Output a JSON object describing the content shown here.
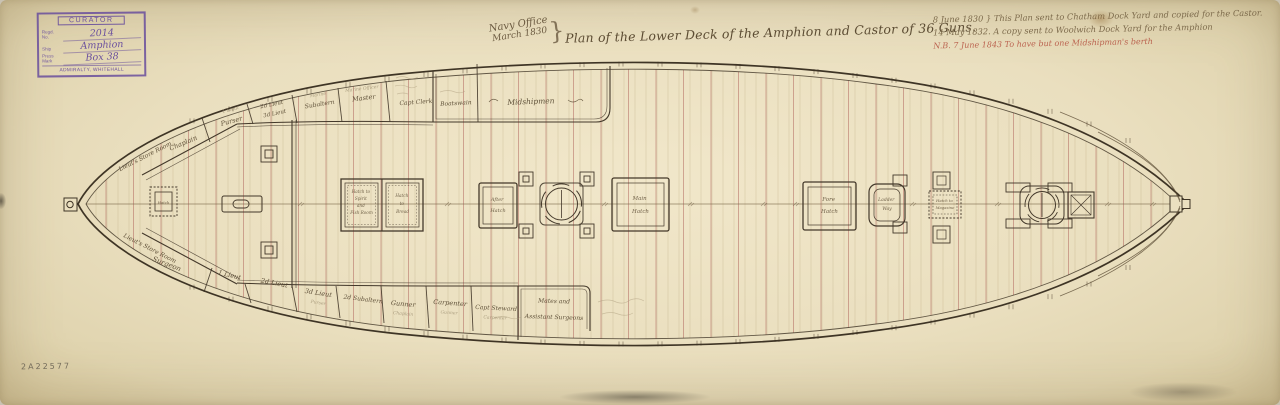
{
  "palette": {
    "paper": "#eadfbf",
    "ink": "#43382a",
    "beam_red": "#a8544e",
    "stamp_purple": "#6a4f9e",
    "annotation_red": "#b4503e"
  },
  "stamp": {
    "title": "CURATOR",
    "rows": [
      {
        "label": "Regd. No.",
        "value": "2014"
      },
      {
        "label": "Ship",
        "value": "Amphion"
      },
      {
        "label": "Press Mark",
        "value": "Box 38"
      }
    ],
    "footer": "ADMIRALTY, WHITEHALL"
  },
  "title_block": {
    "office_line1": "Navy Office",
    "office_line2": "March 1830",
    "brace": "}",
    "title": "Plan of the Lower Deck of the Amphion and Castor of 36 Guns."
  },
  "annotations": {
    "line1": "8 June 1830 }  This Plan sent to Chatham Dock Yard and copied for the Castor.",
    "line2": "14 May 1832.  A copy sent to Woolwich Dock Yard for the Amphion",
    "line3": "N.B. 7 June 1843  To have but one Midshipman's berth"
  },
  "catalogue_number": "2A22577",
  "plan": {
    "store_rooms": {
      "aft_top": "Lieut's Store Room",
      "aft_bottom": "Lieut's Store Room"
    },
    "cabins_top": {
      "c1": "Chaplain",
      "c2": "Purser",
      "c3a": "2d Lieut",
      "c3b": "3d Lieut",
      "c4": "Subaltern",
      "c5": "Master",
      "c6": "Capt Clerk",
      "c7": "Boatswain",
      "c8": "Midshipmen"
    },
    "cabins_top_pencil": {
      "p2": "1 Lieut",
      "p4": "Marine",
      "p5": "Marine Officer"
    },
    "cabins_bottom": {
      "b1": "Surgeon",
      "b2": "1 Lieut",
      "b3": "2d Lieut",
      "b4": "3d Lieut",
      "b5": "2d Subaltern",
      "b6": "Gunner",
      "b7": "Carpenter",
      "b8": "Capt Steward",
      "b9a": "Mates and",
      "b9b": "Assistant Surgeons"
    },
    "cabins_bottom_pencil": {
      "p4": "Purser",
      "p6": "Chaplain",
      "p7": "Gunner",
      "p8": "Carpenter"
    },
    "hatches": {
      "aft_scuttle": {
        "l1": "Hatch"
      },
      "spirit_left": {
        "l1": "Hatch to",
        "l2": "Spirit",
        "l3": "and",
        "l4": "Fish Room"
      },
      "spirit_right": {
        "l1": "Hatch",
        "l2": "to",
        "l3": "Bread"
      },
      "after_hatch": {
        "l1": "After",
        "l2": "Hatch"
      },
      "main_hatch": {
        "l1": "Main",
        "l2": "Hatch"
      },
      "fore_hatch": {
        "l1": "Fore",
        "l2": "Hatch"
      },
      "ladder_way": {
        "l1": "Ladder",
        "l2": "Way"
      },
      "magazine": {
        "l1": "Hatch to",
        "l2": "Magazine"
      }
    }
  }
}
